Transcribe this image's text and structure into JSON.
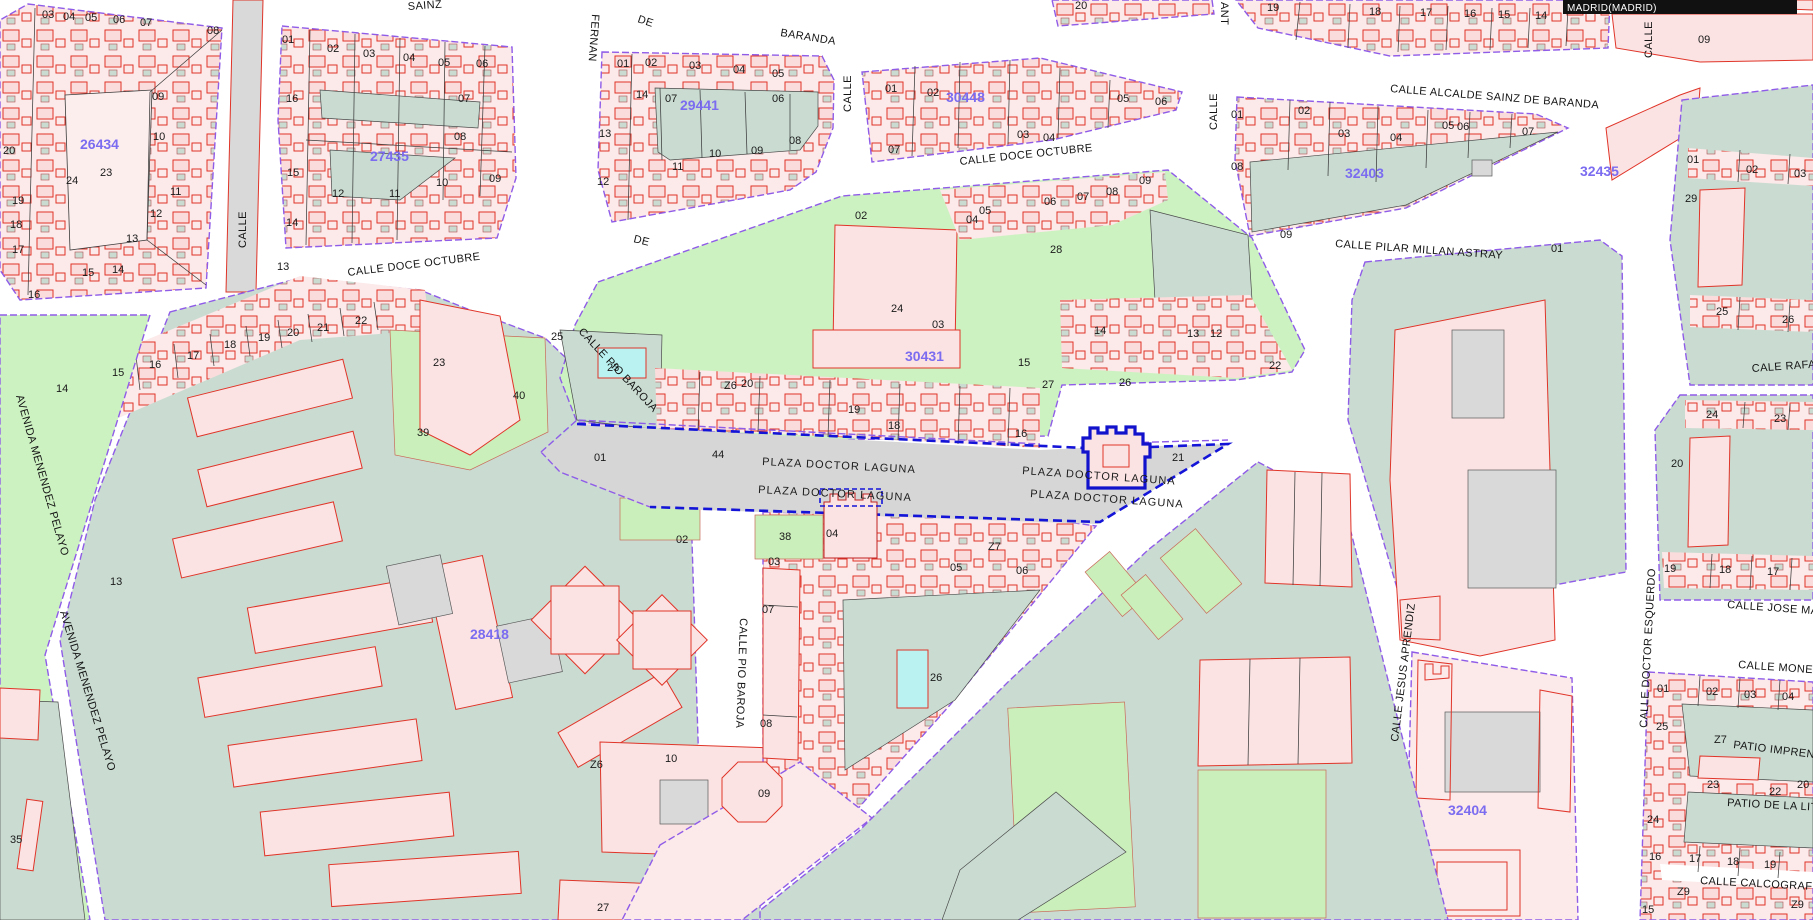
{
  "badge": {
    "text": "MADRID(MADRID)"
  },
  "colors": {
    "block_fill": "#fce9e9",
    "building_outline": "#e03428",
    "block_boundary": "#8f5ce8",
    "courtyard_teal": "#cadcd2",
    "green_area": "#cbefba",
    "plaza_gray": "#d6d6d6",
    "selected_blue": "#1212cc",
    "block_number_purple": "#7b6cf0",
    "pool_cyan": "#b9f2f0",
    "badge_bg": "#111111"
  },
  "plaza": {
    "name_labels": [
      {
        "t": "PLAZA DOCTOR LAGUNA",
        "x": 762,
        "y": 465,
        "r": 3
      },
      {
        "t": "PLAZA DOCTOR LAGUNA",
        "x": 758,
        "y": 493,
        "r": 3
      },
      {
        "t": "PLAZA DOCTOR LAGUNA",
        "x": 1022,
        "y": 474,
        "r": 4
      },
      {
        "t": "PLAZA DOCTOR LAGUNA",
        "x": 1030,
        "y": 497,
        "r": 4
      }
    ]
  },
  "streets": [
    {
      "t": "SAINZ",
      "x": 408,
      "y": 10,
      "r": -4
    },
    {
      "t": "DE",
      "x": 637,
      "y": 22,
      "r": 18
    },
    {
      "t": "BARANDA",
      "x": 780,
      "y": 36,
      "r": 9
    },
    {
      "t": "FERNAN",
      "x": 592,
      "y": 14,
      "r": 94
    },
    {
      "t": "CALLE",
      "x": 246,
      "y": 248,
      "r": -90
    },
    {
      "t": "CALLE",
      "x": 851,
      "y": 112,
      "r": -90
    },
    {
      "t": "CALLE",
      "x": 1217,
      "y": 130,
      "r": -90
    },
    {
      "t": "ANT",
      "x": 1221,
      "y": 2,
      "r": 90
    },
    {
      "t": "CALLE",
      "x": 1652,
      "y": 58,
      "r": -90
    },
    {
      "t": "CALLE ALCALDE SAINZ DE BARANDA",
      "x": 1390,
      "y": 92,
      "r": 4.5
    },
    {
      "t": "CALLE DOCE OCTUBRE",
      "x": 348,
      "y": 276,
      "r": -7
    },
    {
      "t": "CALLE DOCE OCTUBRE",
      "x": 960,
      "y": 165,
      "r": -6
    },
    {
      "t": "CALLE PILAR MILLAN ASTRAY",
      "x": 1335,
      "y": 247,
      "r": 4
    },
    {
      "t": "CALLE PIO BAROJA",
      "x": 578,
      "y": 332,
      "r": 47
    },
    {
      "t": "CALLE PIO BAROJA",
      "x": 740,
      "y": 618,
      "r": 92
    },
    {
      "t": "AVENIDA MENENDEZ PELAYO",
      "x": 16,
      "y": 396,
      "r": 74
    },
    {
      "t": "AVENIDA MENENDEZ PELAYO",
      "x": 60,
      "y": 612,
      "r": 73
    },
    {
      "t": "DE",
      "x": 633,
      "y": 242,
      "r": 14
    },
    {
      "t": "CALLE JESUS APRENDIZ",
      "x": 1398,
      "y": 742,
      "r": -83
    },
    {
      "t": "CALLE DOCTOR ESQUERDO",
      "x": 1647,
      "y": 728,
      "r": -87
    },
    {
      "t": "CALLE JOSE MA",
      "x": 1727,
      "y": 608,
      "r": 4
    },
    {
      "t": "CALLE MONED",
      "x": 1738,
      "y": 668,
      "r": 4
    },
    {
      "t": "CALE RAFA",
      "x": 1752,
      "y": 372,
      "r": -4
    },
    {
      "t": "PATIO IMPREN",
      "x": 1733,
      "y": 748,
      "r": 7
    },
    {
      "t": "PATIO DE LA LIT",
      "x": 1727,
      "y": 806,
      "r": 3
    },
    {
      "t": "CALLE CALCOGRAFI",
      "x": 1700,
      "y": 884,
      "r": 3
    }
  ],
  "block_numbers": [
    {
      "t": "26434",
      "x": 80,
      "y": 149
    },
    {
      "t": "27435",
      "x": 370,
      "y": 161
    },
    {
      "t": "29441",
      "x": 680,
      "y": 110
    },
    {
      "t": "30448",
      "x": 946,
      "y": 102
    },
    {
      "t": "30431",
      "x": 905,
      "y": 361
    },
    {
      "t": "32403",
      "x": 1345,
      "y": 178
    },
    {
      "t": "32435",
      "x": 1580,
      "y": 176
    },
    {
      "t": "28418",
      "x": 470,
      "y": 639
    },
    {
      "t": "32404",
      "x": 1448,
      "y": 815
    }
  ],
  "parcels": [
    {
      "t": "03",
      "x": 42,
      "y": 18
    },
    {
      "t": "04",
      "x": 63,
      "y": 20
    },
    {
      "t": "05",
      "x": 85,
      "y": 21
    },
    {
      "t": "06",
      "x": 113,
      "y": 23
    },
    {
      "t": "07",
      "x": 140,
      "y": 26
    },
    {
      "t": "08",
      "x": 207,
      "y": 34
    },
    {
      "t": "09",
      "x": 152,
      "y": 100
    },
    {
      "t": "10",
      "x": 153,
      "y": 140
    },
    {
      "t": "11",
      "x": 170,
      "y": 195
    },
    {
      "t": "12",
      "x": 150,
      "y": 217
    },
    {
      "t": "13",
      "x": 126,
      "y": 242
    },
    {
      "t": "14",
      "x": 112,
      "y": 273
    },
    {
      "t": "15",
      "x": 82,
      "y": 276
    },
    {
      "t": "16",
      "x": 28,
      "y": 298
    },
    {
      "t": "17",
      "x": 12,
      "y": 253
    },
    {
      "t": "18",
      "x": 10,
      "y": 228
    },
    {
      "t": "19",
      "x": 12,
      "y": 204
    },
    {
      "t": "20",
      "x": 3,
      "y": 154
    },
    {
      "t": "24",
      "x": 66,
      "y": 184
    },
    {
      "t": "23",
      "x": 100,
      "y": 176
    },
    {
      "t": "01",
      "x": 282,
      "y": 43
    },
    {
      "t": "02",
      "x": 327,
      "y": 52
    },
    {
      "t": "03",
      "x": 363,
      "y": 57
    },
    {
      "t": "04",
      "x": 403,
      "y": 61
    },
    {
      "t": "05",
      "x": 438,
      "y": 66
    },
    {
      "t": "06",
      "x": 476,
      "y": 67
    },
    {
      "t": "07",
      "x": 458,
      "y": 102
    },
    {
      "t": "08",
      "x": 454,
      "y": 140
    },
    {
      "t": "09",
      "x": 489,
      "y": 182
    },
    {
      "t": "10",
      "x": 436,
      "y": 186
    },
    {
      "t": "11",
      "x": 389,
      "y": 197
    },
    {
      "t": "12",
      "x": 332,
      "y": 197
    },
    {
      "t": "13",
      "x": 277,
      "y": 270
    },
    {
      "t": "14",
      "x": 286,
      "y": 226
    },
    {
      "t": "15",
      "x": 287,
      "y": 176
    },
    {
      "t": "16",
      "x": 286,
      "y": 102
    },
    {
      "t": "01",
      "x": 617,
      "y": 67
    },
    {
      "t": "02",
      "x": 645,
      "y": 66
    },
    {
      "t": "03",
      "x": 689,
      "y": 69
    },
    {
      "t": "04",
      "x": 733,
      "y": 73
    },
    {
      "t": "05",
      "x": 772,
      "y": 77
    },
    {
      "t": "06",
      "x": 772,
      "y": 102
    },
    {
      "t": "07",
      "x": 665,
      "y": 102
    },
    {
      "t": "08",
      "x": 789,
      "y": 144
    },
    {
      "t": "09",
      "x": 751,
      "y": 154
    },
    {
      "t": "10",
      "x": 709,
      "y": 157
    },
    {
      "t": "11",
      "x": 672,
      "y": 170
    },
    {
      "t": "12",
      "x": 597,
      "y": 185
    },
    {
      "t": "13",
      "x": 599,
      "y": 137
    },
    {
      "t": "14",
      "x": 636,
      "y": 98
    },
    {
      "t": "01",
      "x": 885,
      "y": 92
    },
    {
      "t": "02",
      "x": 927,
      "y": 96
    },
    {
      "t": "03",
      "x": 1017,
      "y": 138
    },
    {
      "t": "04",
      "x": 1043,
      "y": 141
    },
    {
      "t": "05",
      "x": 1117,
      "y": 102
    },
    {
      "t": "06",
      "x": 1155,
      "y": 105
    },
    {
      "t": "07",
      "x": 888,
      "y": 153
    },
    {
      "t": "01",
      "x": 1231,
      "y": 118
    },
    {
      "t": "02",
      "x": 1298,
      "y": 114
    },
    {
      "t": "03",
      "x": 1338,
      "y": 137
    },
    {
      "t": "04",
      "x": 1390,
      "y": 141
    },
    {
      "t": "05",
      "x": 1442,
      "y": 129
    },
    {
      "t": "06",
      "x": 1457,
      "y": 130
    },
    {
      "t": "07",
      "x": 1522,
      "y": 135
    },
    {
      "t": "08",
      "x": 1231,
      "y": 170
    },
    {
      "t": "09",
      "x": 1280,
      "y": 238
    },
    {
      "t": "20",
      "x": 1075,
      "y": 9
    },
    {
      "t": "19",
      "x": 1267,
      "y": 11
    },
    {
      "t": "18",
      "x": 1369,
      "y": 15
    },
    {
      "t": "17",
      "x": 1420,
      "y": 16
    },
    {
      "t": "16",
      "x": 1464,
      "y": 17
    },
    {
      "t": "15",
      "x": 1498,
      "y": 18
    },
    {
      "t": "14",
      "x": 1535,
      "y": 19
    },
    {
      "t": "09",
      "x": 1698,
      "y": 43
    },
    {
      "t": "02",
      "x": 855,
      "y": 219
    },
    {
      "t": "24",
      "x": 891,
      "y": 312
    },
    {
      "t": "03",
      "x": 932,
      "y": 328
    },
    {
      "t": "04",
      "x": 966,
      "y": 223
    },
    {
      "t": "05",
      "x": 979,
      "y": 214
    },
    {
      "t": "06",
      "x": 1044,
      "y": 205
    },
    {
      "t": "07",
      "x": 1077,
      "y": 200
    },
    {
      "t": "08",
      "x": 1106,
      "y": 195
    },
    {
      "t": "09",
      "x": 1139,
      "y": 184
    },
    {
      "t": "28",
      "x": 1050,
      "y": 253
    },
    {
      "t": "25",
      "x": 551,
      "y": 340
    },
    {
      "t": "23",
      "x": 607,
      "y": 371
    },
    {
      "t": "40",
      "x": 513,
      "y": 399
    },
    {
      "t": "39",
      "x": 417,
      "y": 436
    },
    {
      "t": "Z6",
      "x": 724,
      "y": 389
    },
    {
      "t": "20",
      "x": 741,
      "y": 387
    },
    {
      "t": "19",
      "x": 848,
      "y": 413
    },
    {
      "t": "18",
      "x": 888,
      "y": 429
    },
    {
      "t": "16",
      "x": 1015,
      "y": 437
    },
    {
      "t": "15",
      "x": 1018,
      "y": 366
    },
    {
      "t": "27",
      "x": 1042,
      "y": 388
    },
    {
      "t": "26",
      "x": 1119,
      "y": 386
    },
    {
      "t": "14",
      "x": 1094,
      "y": 334
    },
    {
      "t": "13",
      "x": 1187,
      "y": 337
    },
    {
      "t": "12",
      "x": 1210,
      "y": 337
    },
    {
      "t": "22",
      "x": 1269,
      "y": 369
    },
    {
      "t": "21",
      "x": 1172,
      "y": 461
    },
    {
      "t": "14",
      "x": 56,
      "y": 392
    },
    {
      "t": "15",
      "x": 112,
      "y": 376
    },
    {
      "t": "16",
      "x": 149,
      "y": 368
    },
    {
      "t": "17",
      "x": 187,
      "y": 359
    },
    {
      "t": "18",
      "x": 224,
      "y": 348
    },
    {
      "t": "19",
      "x": 258,
      "y": 341
    },
    {
      "t": "20",
      "x": 287,
      "y": 336
    },
    {
      "t": "21",
      "x": 317,
      "y": 331
    },
    {
      "t": "22",
      "x": 355,
      "y": 324
    },
    {
      "t": "23",
      "x": 433,
      "y": 366
    },
    {
      "t": "13",
      "x": 110,
      "y": 585
    },
    {
      "t": "01",
      "x": 594,
      "y": 461
    },
    {
      "t": "10",
      "x": 665,
      "y": 762
    },
    {
      "t": "Z6",
      "x": 590,
      "y": 768
    },
    {
      "t": "27",
      "x": 597,
      "y": 911
    },
    {
      "t": "35",
      "x": 10,
      "y": 843
    },
    {
      "t": "38",
      "x": 779,
      "y": 540
    },
    {
      "t": "44",
      "x": 712,
      "y": 458
    },
    {
      "t": "03",
      "x": 768,
      "y": 565
    },
    {
      "t": "04",
      "x": 826,
      "y": 537
    },
    {
      "t": "Z7",
      "x": 988,
      "y": 550
    },
    {
      "t": "05",
      "x": 950,
      "y": 571
    },
    {
      "t": "06",
      "x": 1016,
      "y": 574
    },
    {
      "t": "07",
      "x": 762,
      "y": 613
    },
    {
      "t": "26",
      "x": 930,
      "y": 681
    },
    {
      "t": "08",
      "x": 760,
      "y": 727
    },
    {
      "t": "09",
      "x": 758,
      "y": 797
    },
    {
      "t": "02",
      "x": 676,
      "y": 543
    },
    {
      "t": "01",
      "x": 1551,
      "y": 252
    },
    {
      "t": "01",
      "x": 1687,
      "y": 163
    },
    {
      "t": "02",
      "x": 1746,
      "y": 173
    },
    {
      "t": "03",
      "x": 1794,
      "y": 177
    },
    {
      "t": "29",
      "x": 1685,
      "y": 202
    },
    {
      "t": "25",
      "x": 1716,
      "y": 315
    },
    {
      "t": "26",
      "x": 1782,
      "y": 323
    },
    {
      "t": "24",
      "x": 1706,
      "y": 418
    },
    {
      "t": "23",
      "x": 1774,
      "y": 422
    },
    {
      "t": "20",
      "x": 1671,
      "y": 467
    },
    {
      "t": "19",
      "x": 1664,
      "y": 572
    },
    {
      "t": "18",
      "x": 1719,
      "y": 573
    },
    {
      "t": "17",
      "x": 1767,
      "y": 575
    },
    {
      "t": "01",
      "x": 1657,
      "y": 692
    },
    {
      "t": "02",
      "x": 1706,
      "y": 695
    },
    {
      "t": "03",
      "x": 1744,
      "y": 698
    },
    {
      "t": "04",
      "x": 1782,
      "y": 700
    },
    {
      "t": "25",
      "x": 1656,
      "y": 730
    },
    {
      "t": "Z7",
      "x": 1714,
      "y": 743
    },
    {
      "t": "23",
      "x": 1707,
      "y": 788
    },
    {
      "t": "22",
      "x": 1769,
      "y": 795
    },
    {
      "t": "20",
      "x": 1797,
      "y": 788
    },
    {
      "t": "24",
      "x": 1647,
      "y": 823
    },
    {
      "t": "16",
      "x": 1649,
      "y": 860
    },
    {
      "t": "17",
      "x": 1689,
      "y": 862
    },
    {
      "t": "18",
      "x": 1727,
      "y": 865
    },
    {
      "t": "19",
      "x": 1764,
      "y": 868
    },
    {
      "t": "Z9",
      "x": 1677,
      "y": 895
    },
    {
      "t": "Z9",
      "x": 1791,
      "y": 908
    },
    {
      "t": "15",
      "x": 1642,
      "y": 913
    }
  ]
}
